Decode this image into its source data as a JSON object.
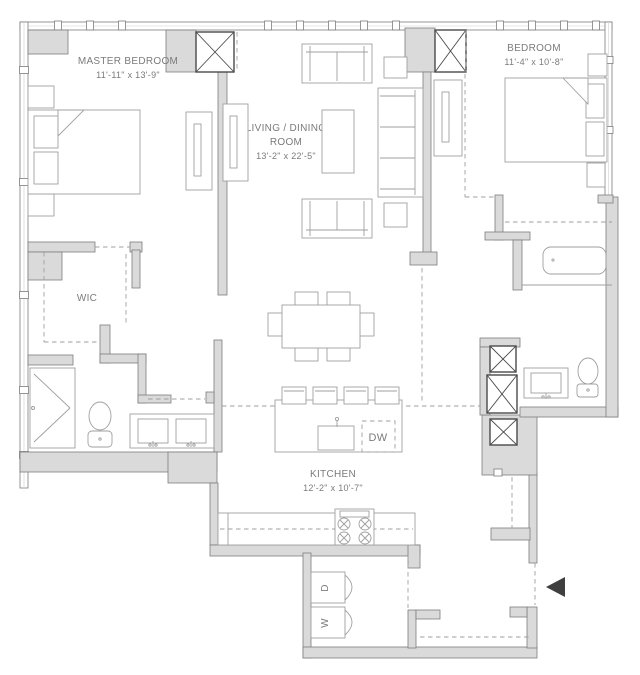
{
  "title": "Two Bedroom Apartment Floor Plan",
  "colors": {
    "background": "#ffffff",
    "wall_fill": "#dadada",
    "wall_stroke": "#7d7d7d",
    "furniture": "#9f9f9f",
    "text": "#7b7b7b",
    "shaft": "#4a4a4a",
    "marker": "#3f3f3f"
  },
  "rooms": {
    "master_bedroom": {
      "name": "MASTER BEDROOM",
      "dimensions": "11'-11\" x 13'-9\""
    },
    "living_dining": {
      "name_line1": "LIVING / DINING",
      "name_line2": "ROOM",
      "dimensions": "13'-2\" x 22'-5\""
    },
    "bedroom": {
      "name": "BEDROOM",
      "dimensions": "11'-4\" x 10'-8\""
    },
    "wic": {
      "name": "WIC"
    },
    "kitchen": {
      "name": "KITCHEN",
      "dimensions": "12'-2\" x 10'-7\""
    }
  },
  "appliances": {
    "dishwasher": "DW",
    "dryer": "D",
    "washer": "W"
  }
}
